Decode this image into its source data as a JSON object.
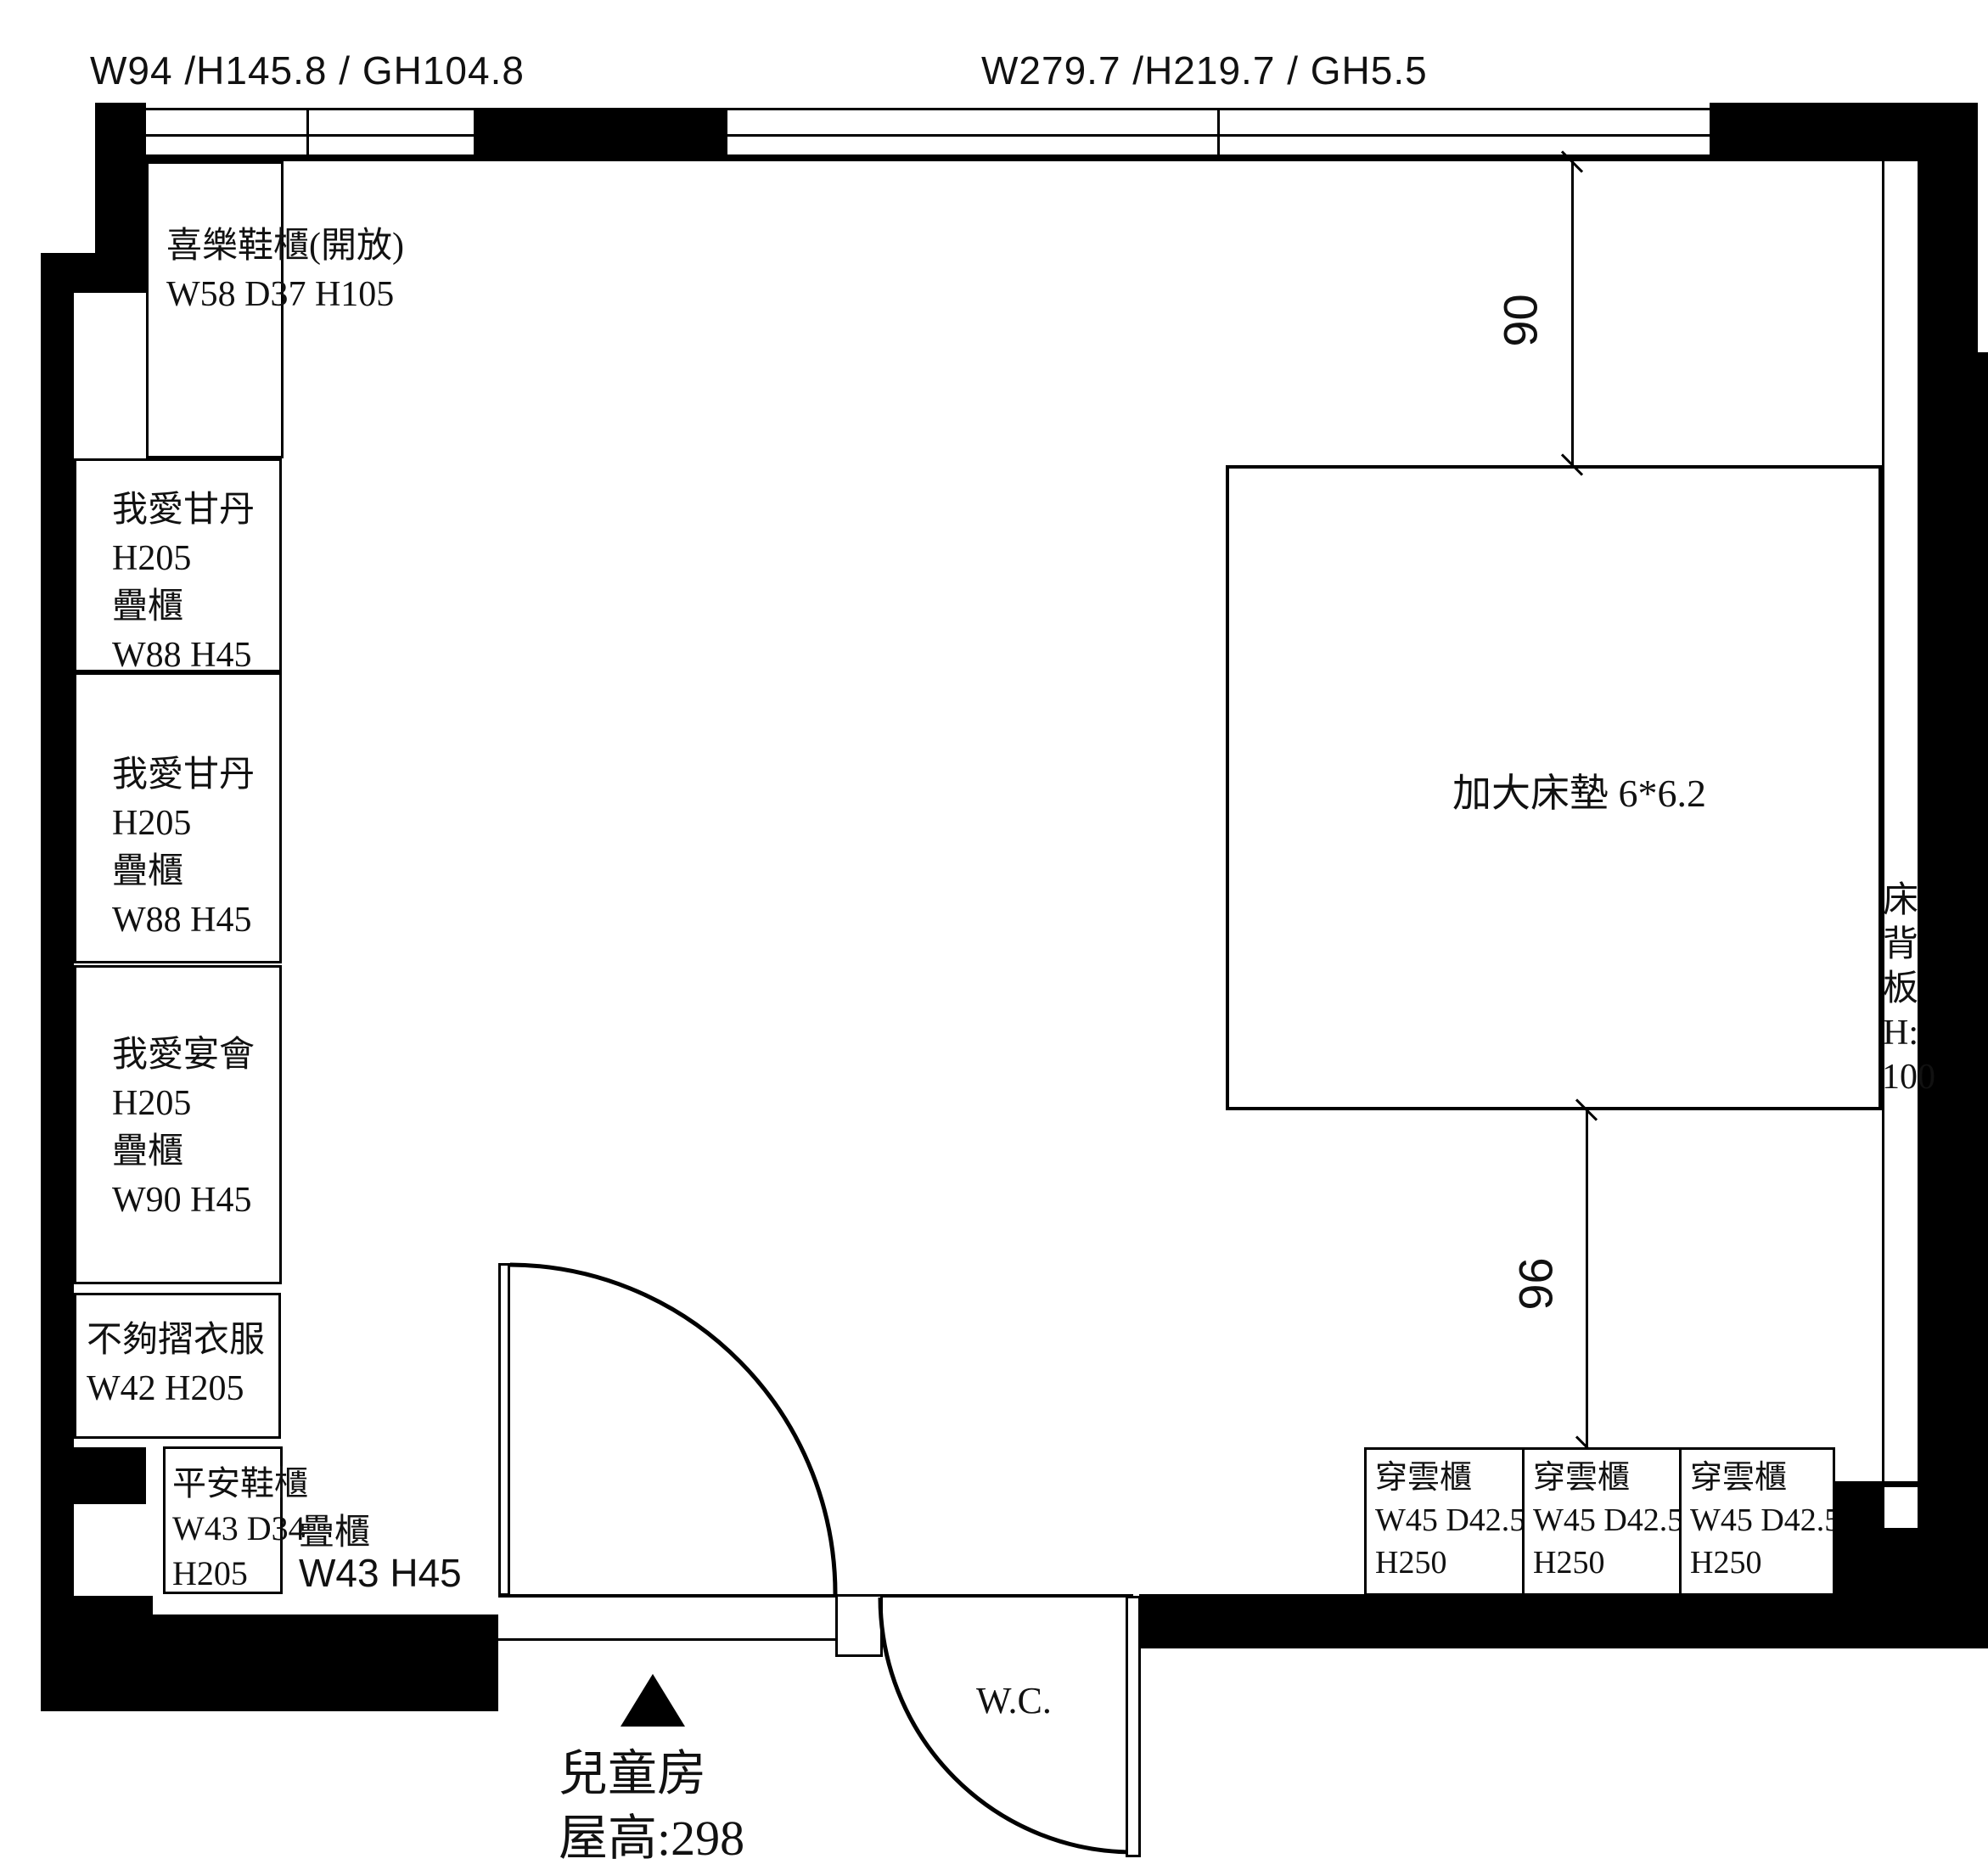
{
  "colors": {
    "wall": "#000000",
    "line": "#000000",
    "background": "#ffffff"
  },
  "window_labels": {
    "left": "W94 /H145.8 / GH104.8",
    "center": "W279.7 /H219.7 / GH5.5"
  },
  "left_column": {
    "boxes": [
      {
        "lines": [
          "喜樂鞋櫃(開放)",
          "W58 D37 H105"
        ]
      },
      {
        "lines": [
          "我愛甘丹",
          "H205",
          "疊櫃",
          "W88 H45"
        ]
      },
      {
        "lines": [
          "我愛甘丹",
          "H205",
          "疊櫃",
          "W88 H45"
        ]
      },
      {
        "lines": [
          "我愛宴會",
          "H205",
          "疊櫃",
          "W90 H45"
        ]
      },
      {
        "lines": [
          "不夠摺衣服",
          "W42 H205"
        ]
      },
      {
        "lines": [
          "平安鞋櫃",
          "W43 D34",
          "H205"
        ]
      }
    ]
  },
  "stack_cabinet_label": {
    "name": "疊櫃",
    "size": "W43 H45"
  },
  "bed": {
    "label": "加大床墊 6*6.2"
  },
  "headboard": {
    "lines": [
      "床",
      "背",
      "板",
      "H:",
      "100"
    ]
  },
  "dimensions": {
    "top": "90",
    "bottom": "96"
  },
  "bottom_cabinets": [
    {
      "lines": [
        "穿雲櫃",
        "W45 D42.5",
        "H250"
      ]
    },
    {
      "lines": [
        "穿雲櫃",
        "W45 D42.5",
        "H250"
      ]
    },
    {
      "lines": [
        "穿雲櫃",
        "W45 D42.5",
        "H250"
      ]
    }
  ],
  "wc": {
    "label": "W.C."
  },
  "room": {
    "name": "兒童房",
    "ceiling_height": "屋高:298"
  }
}
